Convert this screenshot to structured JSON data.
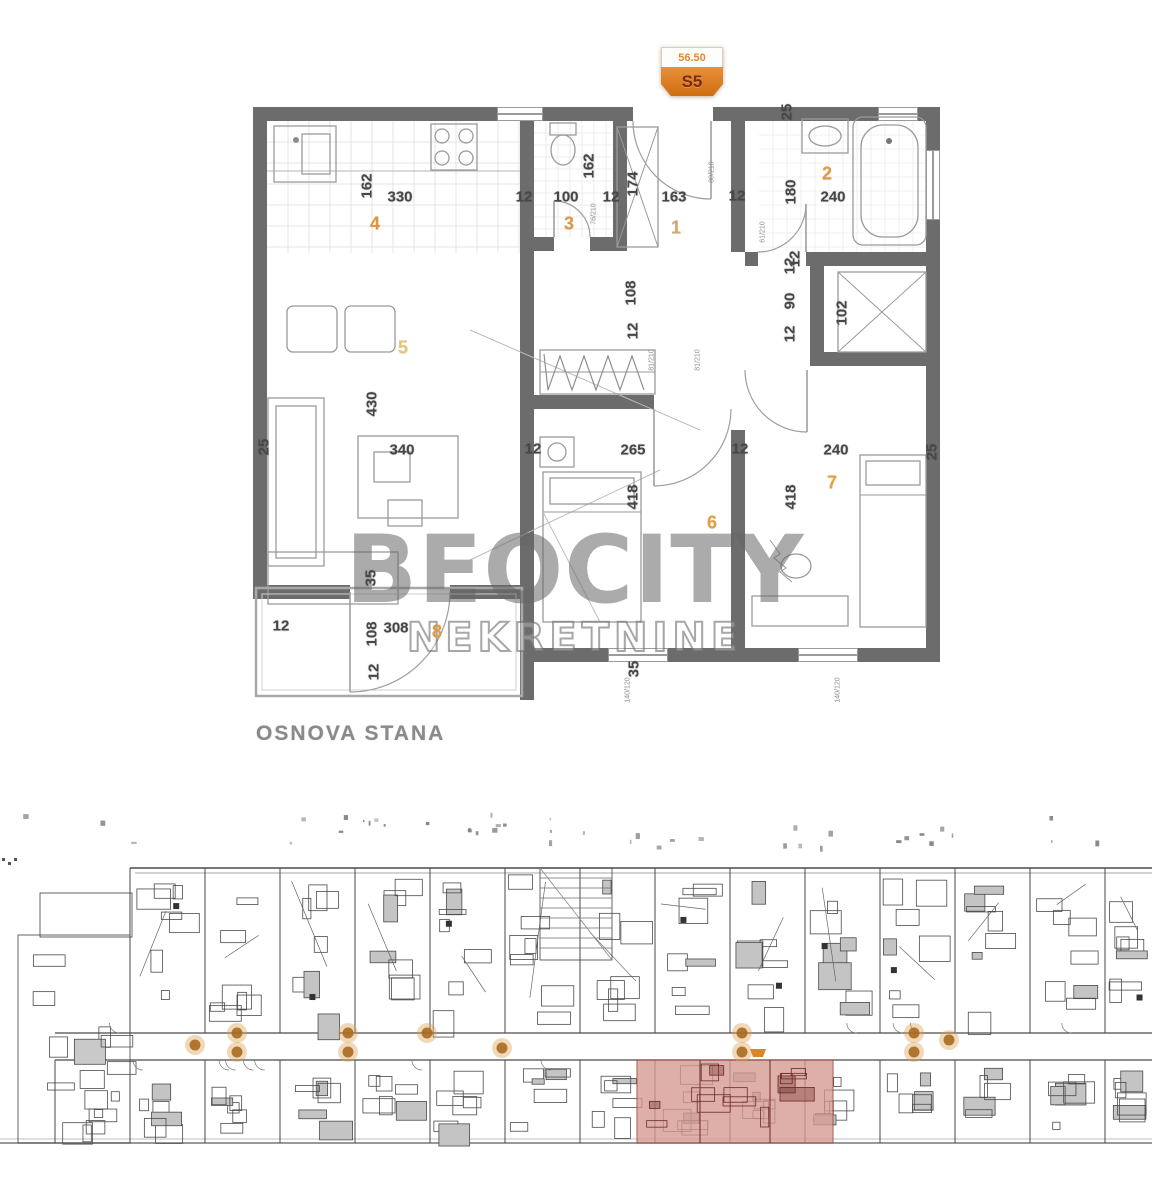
{
  "badge": {
    "area": "56.50",
    "unit": "S5"
  },
  "plan_title": "OSNOVA STANA",
  "watermark": {
    "line1": "BEOCITY",
    "line2": "NEKRETNINE"
  },
  "colors": {
    "wall": "#6c6c6c",
    "badge_orange": "#dd7d22",
    "badge_text": "#7a2c10",
    "area_text": "#e08a2e",
    "room_number_default": "#dba257",
    "highlight_fill": "#d69992",
    "highlight_line": "#6d2a26",
    "corridor_dot": "#a9691f",
    "title_gray": "#8a8a8a"
  },
  "top_plan": {
    "room_numbers": [
      {
        "t": "1",
        "x": 676,
        "y": 228,
        "color": "#cfa875"
      },
      {
        "t": "2",
        "x": 827,
        "y": 174,
        "color": "#e09a43"
      },
      {
        "t": "3",
        "x": 569,
        "y": 224,
        "color": "#d99a4e"
      },
      {
        "t": "4",
        "x": 375,
        "y": 224,
        "color": "#e0953a"
      },
      {
        "t": "5",
        "x": 403,
        "y": 348,
        "color": "#e3c77b"
      },
      {
        "t": "6",
        "x": 712,
        "y": 523,
        "color": "#dfa049"
      },
      {
        "t": "7",
        "x": 832,
        "y": 483,
        "color": "#e0a14b"
      },
      {
        "t": "8",
        "x": 437,
        "y": 632,
        "color": "#e09a45"
      }
    ],
    "dimensions": [
      {
        "t": "162",
        "x": 367,
        "y": 186,
        "v": true
      },
      {
        "t": "330",
        "x": 400,
        "y": 197
      },
      {
        "t": "12",
        "x": 524,
        "y": 197
      },
      {
        "t": "100",
        "x": 566,
        "y": 197
      },
      {
        "t": "12",
        "x": 611,
        "y": 197
      },
      {
        "t": "162",
        "x": 589,
        "y": 166,
        "v": true
      },
      {
        "t": "174",
        "x": 633,
        "y": 184,
        "v": true
      },
      {
        "t": "163",
        "x": 674,
        "y": 197
      },
      {
        "t": "12",
        "x": 737,
        "y": 196
      },
      {
        "t": "25",
        "x": 787,
        "y": 112,
        "v": true
      },
      {
        "t": "180",
        "x": 791,
        "y": 192,
        "v": true
      },
      {
        "t": "240",
        "x": 833,
        "y": 197
      },
      {
        "t": "12",
        "x": 795,
        "y": 259,
        "v": true
      },
      {
        "t": "108",
        "x": 631,
        "y": 293,
        "v": true
      },
      {
        "t": "12",
        "x": 633,
        "y": 331,
        "v": true
      },
      {
        "t": "12",
        "x": 790,
        "y": 266,
        "v": true
      },
      {
        "t": "90",
        "x": 790,
        "y": 301,
        "v": true
      },
      {
        "t": "12",
        "x": 790,
        "y": 334,
        "v": true
      },
      {
        "t": "102",
        "x": 842,
        "y": 313,
        "v": true
      },
      {
        "t": "25",
        "x": 264,
        "y": 447,
        "v": true
      },
      {
        "t": "430",
        "x": 372,
        "y": 404,
        "v": true
      },
      {
        "t": "340",
        "x": 402,
        "y": 450
      },
      {
        "t": "12",
        "x": 533,
        "y": 449
      },
      {
        "t": "265",
        "x": 633,
        "y": 450
      },
      {
        "t": "12",
        "x": 740,
        "y": 449
      },
      {
        "t": "240",
        "x": 836,
        "y": 450
      },
      {
        "t": "25",
        "x": 932,
        "y": 452,
        "v": true
      },
      {
        "t": "418",
        "x": 633,
        "y": 497,
        "v": true
      },
      {
        "t": "418",
        "x": 791,
        "y": 497,
        "v": true
      },
      {
        "t": "35",
        "x": 371,
        "y": 578,
        "v": true
      },
      {
        "t": "12",
        "x": 281,
        "y": 626
      },
      {
        "t": "108",
        "x": 372,
        "y": 634,
        "v": true
      },
      {
        "t": "308",
        "x": 396,
        "y": 628
      },
      {
        "t": "12",
        "x": 374,
        "y": 672,
        "v": true
      },
      {
        "t": "35",
        "x": 634,
        "y": 669,
        "v": true
      }
    ],
    "annotations": [
      {
        "t": "80/210",
        "x": 712,
        "y": 172
      },
      {
        "t": "76/210",
        "x": 594,
        "y": 214
      },
      {
        "t": "61/210",
        "x": 763,
        "y": 232
      },
      {
        "t": "81/210",
        "x": 652,
        "y": 360
      },
      {
        "t": "81/210",
        "x": 698,
        "y": 360
      },
      {
        "t": "140/120",
        "x": 628,
        "y": 690
      },
      {
        "t": "140/120",
        "x": 838,
        "y": 690
      }
    ]
  },
  "bottom_plan": {
    "highlight": {
      "x": 637,
      "y": 1060,
      "w": 196,
      "h": 83
    },
    "corridor_dots": [
      [
        195,
        1045
      ],
      [
        237,
        1033
      ],
      [
        237,
        1052
      ],
      [
        348,
        1033
      ],
      [
        348,
        1052
      ],
      [
        427,
        1033
      ],
      [
        502,
        1048
      ],
      [
        742,
        1033
      ],
      [
        742,
        1052
      ],
      [
        914,
        1033
      ],
      [
        914,
        1052
      ],
      [
        949,
        1040
      ]
    ],
    "entry_marker": {
      "x": 750,
      "y": 1049,
      "w": 16,
      "h": 8
    }
  }
}
